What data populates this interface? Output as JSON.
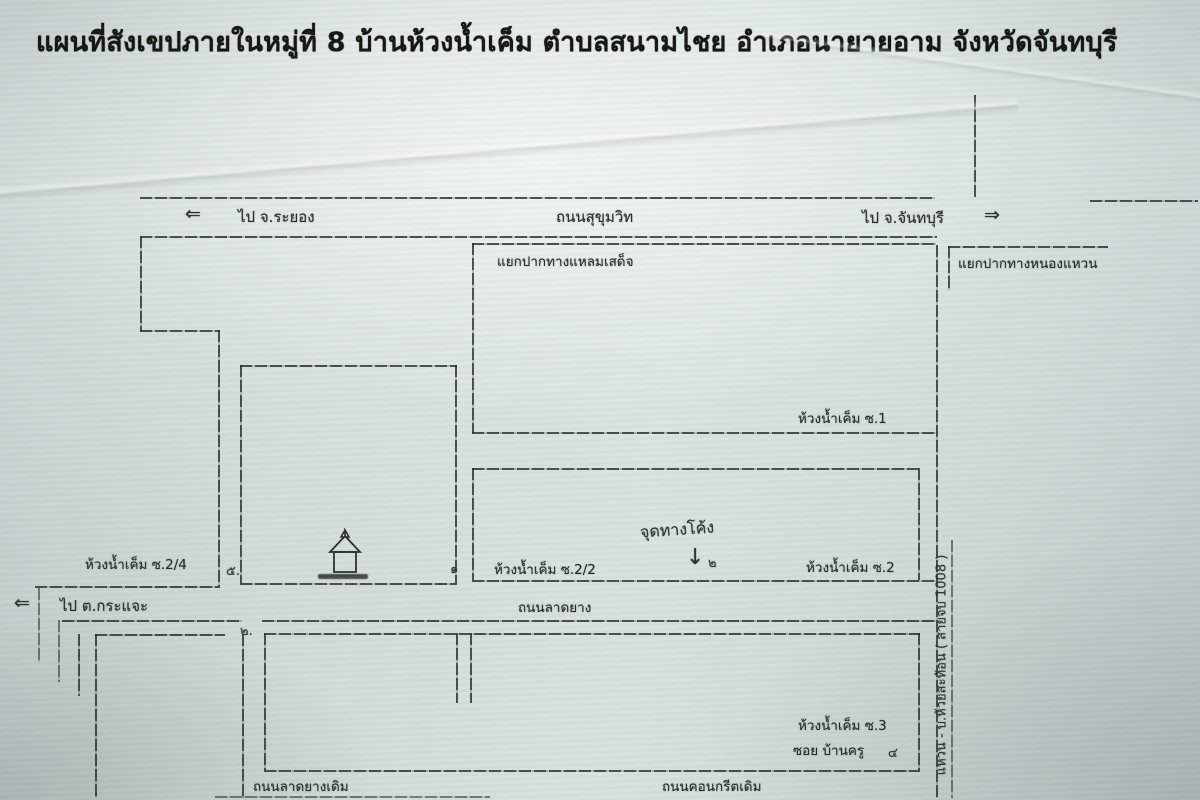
{
  "page": {
    "title": "แผนที่สังเขปภายในหมู่ที่ 8  บ้านห้วงน้ำเค็ม  ตำบลสนามไชย  อำเภอนายายอาม  จังหวัดจันทบุรี"
  },
  "icons": {
    "arrow_left": "⇐",
    "arrow_right": "⇒",
    "arrow_down": "↓"
  },
  "map": {
    "highways": {
      "sukhumvit": "ถนนสุขุมวิท",
      "to_rayong": "ไป จ.ระยอง",
      "to_chanthaburi": "ไป จ.จันทบุรี",
      "to_krachae": "ไป ต.กระแจะ"
    },
    "junctions": {
      "laem_sadet": "แยกปากทางแหลมเสด็จ",
      "nong_waen": "แยกปากทางหนองแหวน"
    },
    "roads": {
      "asphalt": "ถนนลาดยาง",
      "old_asphalt": "ถนนลาดยางเดิม",
      "old_concrete": "ถนนคอนกรีตเดิม",
      "rural_route": "แหวน - บ.ห้วยสะท้อน ( สายจบ 1008 )"
    },
    "sois": {
      "soi_1": "ห้วงน้ำเค็ม ซ.1",
      "soi_2": "ห้วงน้ำเค็ม ซ.2",
      "soi_2_2": "ห้วงน้ำเค็ม ซ.2/2",
      "soi_2_4": "ห้วงน้ำเค็ม ซ.2/4",
      "soi_3": "ห้วงน้ำเค็ม ซ.3",
      "soi_ban_khru": "ซอย บ้านครู"
    },
    "annotations": {
      "curve_point": "จุดทางโค้ง",
      "mark_1": "๑",
      "mark_2": "๒",
      "mark_2b": "๒.",
      "mark_4": "๔",
      "mark_5": "๕."
    }
  }
}
